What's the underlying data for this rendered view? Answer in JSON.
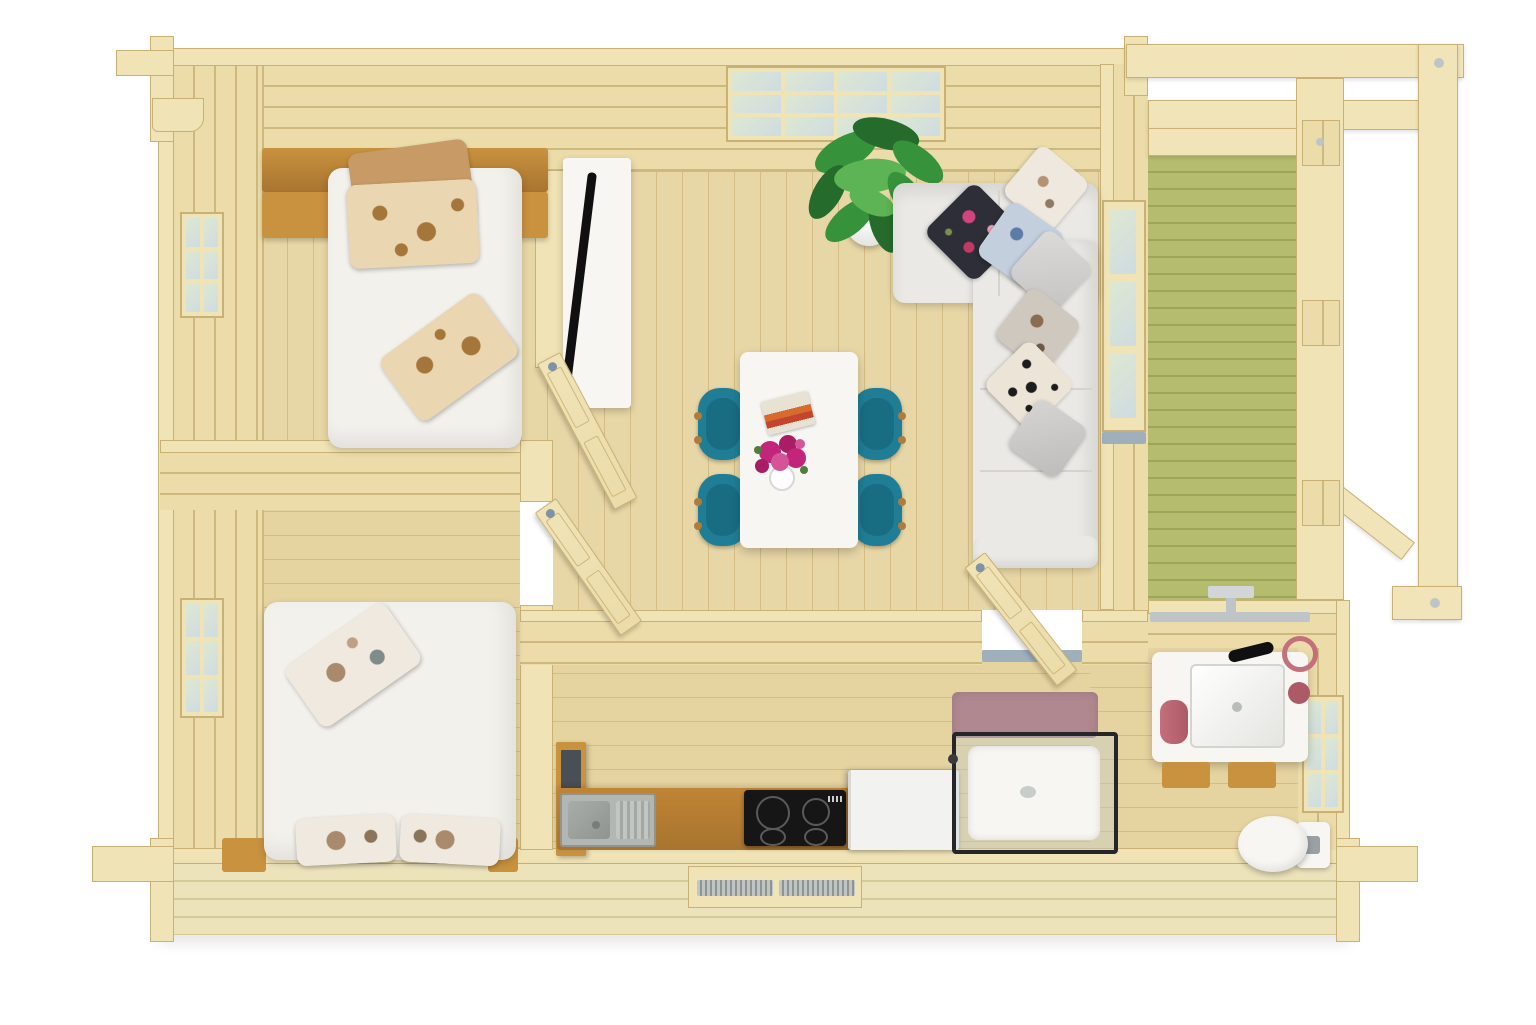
{
  "scene": {
    "kind": "3d-rendered floor plan, top view",
    "subject": "log cabin with furnished interior and side veranda",
    "text_visible": "none"
  },
  "colors": {
    "background": "#ffffff",
    "wood_edge": "#f0e3b6",
    "wood_edge_border": "#c9b176",
    "wood_face": "#ecdcaa",
    "wood_face_line": "#cdb97e",
    "wood_beam": "#f0e4b8",
    "floor": "#e8d7a6",
    "floor2": "#e5d3a0",
    "floor_line": "#d3bd85",
    "deck": "#b6bc6e",
    "deck_line": "#9ba65a",
    "oak": "#c9923f",
    "oak_dark": "#a87430",
    "counter_oak": "#c08434",
    "white": "#f7f6f3",
    "sofa": "#eae9e5",
    "sofa_line": "#d6d3cc",
    "duvet": "#f3f1ec",
    "teal": "#1f7e96",
    "teal_dark": "#145f74",
    "wood_leg": "#b07c3e",
    "plant": "#36933c",
    "plant_dark": "#256b2c",
    "plant_light": "#5cb455",
    "magenta": "#c22579",
    "tv_black": "#101010",
    "cooktop": "#161616",
    "ring": "#5a5a5a",
    "steel": "#b3b7b4",
    "steel_dark": "#8f948f",
    "fridge": "#f2f2f0",
    "pink": "#c4707b",
    "pink_dark": "#ad5a68",
    "mauve": "#b08890",
    "glass": "#dde8d2",
    "glass_blue": "#cfdce0",
    "threshold": "#9fb0bc",
    "hinge": "#7e93a8",
    "frame_gray": "#bfc4c6",
    "shower_frame": "#26262a",
    "pillow_tan": "#c79a66",
    "pillow_floral_base": "#ead6b0",
    "pillow_floral_dot": "#a4763a",
    "pillow_dark": "#2e2e38",
    "exterior_face": "#ece3bb",
    "exterior_line": "#d6cb96"
  },
  "rooms": [
    {
      "id": "bedroom-1",
      "name": "Bedroom (single bed), top-left"
    },
    {
      "id": "bedroom-2",
      "name": "Bedroom (double bed), bottom-left"
    },
    {
      "id": "living-dining",
      "name": "Living / dining room, center"
    },
    {
      "id": "kitchen",
      "name": "Kitchen corridor along bottom wall"
    },
    {
      "id": "bathroom",
      "name": "Bathroom, bottom-right"
    },
    {
      "id": "veranda",
      "name": "Veranda with green deck and pergola, right"
    }
  ],
  "furniture": [
    "single-bed with white duvet, tan and floral pillows, oak headboard shelf",
    "double-bed with white duvet and floral pillows, oak side blocks",
    "tv-stand with flat tv",
    "l-shaped white sofa with seven decorative pillows",
    "white dining table with book and magenta flower vase",
    "four teal wingback chairs",
    "potted green plant",
    "kitchen counter with steel sink, induction cooktop, white fridge",
    "bathroom vanity with basin, black faucet, pink towels, two stools",
    "mirror light bar",
    "glass shower cabin with white tray",
    "mauve bath mat",
    "toilet",
    "leaning frames panel"
  ],
  "windows": [
    "double window on top wall (living room)",
    "window on left wall (bedroom 1)",
    "window on left wall (bedroom 2)",
    "window on right wall (bathroom)"
  ],
  "doors": [
    "bedroom-1 open door leaf",
    "bedroom-2 open door leaf",
    "bathroom open door leaf",
    "glazed veranda door in right wall"
  ]
}
